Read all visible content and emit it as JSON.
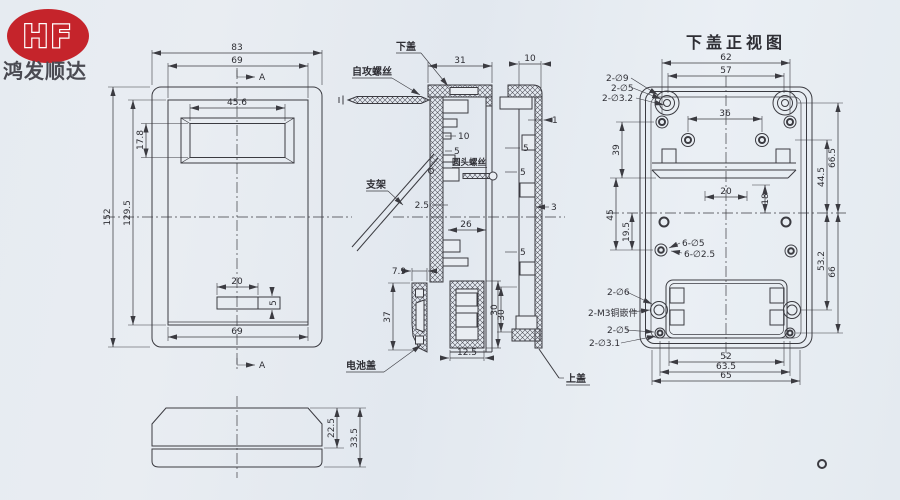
{
  "logo": {
    "brand": "HF",
    "company": "鸿发顺达"
  },
  "colors": {
    "accent_red": "#c5242b",
    "line": "#3b3b41",
    "paper": "#e8edf2"
  },
  "front_view": {
    "dim_outer_width": "83",
    "dim_inner_width_top": "69",
    "dim_window_width": "45.6",
    "dim_window_height": "17.8",
    "dim_outer_height": "152",
    "dim_inner_height": "129.5",
    "dim_slot_width": "20",
    "dim_slot_height": "5",
    "dim_inner_width_bottom": "69",
    "section_marker": "A"
  },
  "section_bottom_cover": {
    "label_part": "下盖",
    "dim_depth": "31",
    "label_screw_self_tapping": "自攻螺丝",
    "dim_10": "10",
    "dim_5": "5",
    "label_screw_round_head": "圆头螺丝",
    "label_bracket": "支架",
    "dim_2_5": "2.5",
    "dim_26": "26",
    "dim_battery_width_top": "7.9",
    "dim_battery_height": "37",
    "label_battery_cover": "电池盖",
    "dim_battery_width_bottom": "12.5",
    "dim_battery_box_height": "30"
  },
  "section_top_cover": {
    "dim_depth": "10",
    "dim_wall_1": "1",
    "dim_rib_5a": "5",
    "dim_rib_5b": "5",
    "dim_wall_3": "3",
    "dim_rib_5c": "5",
    "dim_30": "30",
    "label_part": "上盖"
  },
  "bottom_cover_view": {
    "title": "下盖正视图",
    "dim_62": "62",
    "dim_57": "57",
    "dim_36": "36",
    "label_2d9": "2-∅9",
    "label_2d5_top": "2-∅5",
    "label_2d32": "2-∅3.2",
    "dim_39": "39",
    "dim_45": "45",
    "dim_19_5": "19.5",
    "dim_20": "20",
    "dim_18": "18",
    "label_6d5": "6-∅5",
    "label_6d25": "6-∅2.5",
    "label_2d6": "2-∅6",
    "label_m3": "2-M3铜嵌件",
    "label_2d5_bottom": "2-∅5",
    "label_2d31": "2-∅3.1",
    "dim_52": "52",
    "dim_63_5": "63.5",
    "dim_65": "65",
    "dim_66_5": "66.5",
    "dim_44_5": "44.5",
    "dim_53_2": "53.2",
    "dim_66": "66"
  },
  "profile_view": {
    "dim_22_5": "22.5",
    "dim_33_5": "33.5"
  }
}
